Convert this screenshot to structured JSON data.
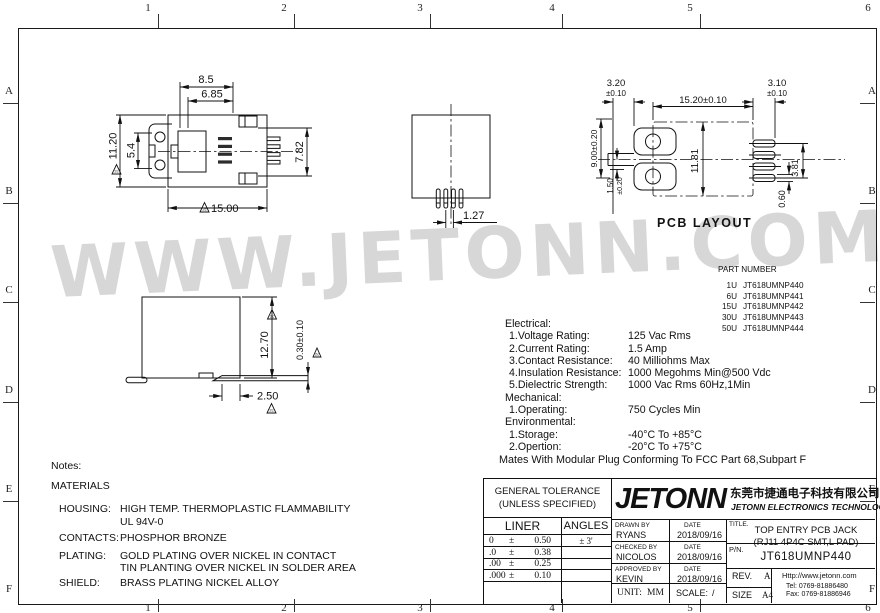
{
  "frame": {
    "cols": [
      "1",
      "2",
      "3",
      "4",
      "5",
      "6"
    ],
    "rows": [
      "A",
      "B",
      "C",
      "D",
      "E",
      "F"
    ]
  },
  "watermark": "WWW.JETONN.COM",
  "dims": {
    "rev_marker": "2c",
    "top_view": {
      "w_outer": "8.5",
      "w_inner": "6.85",
      "h_outer": "11.20",
      "h_inner": "5.4",
      "h_right": "7.82",
      "w_body": "15.00"
    },
    "front_view": {
      "pitch": "1.27"
    },
    "pcb": {
      "label": "PCB LAYOUT",
      "pad_left_w": "3.20",
      "pad_left_tol": "±0.10",
      "body_w": "15.20±0.10",
      "pad_right_w": "3.10",
      "pad_right_tol": "±0.10",
      "v_span": "9.00±0.20",
      "slot_h": "1.50",
      "slot_tol": "±0.20",
      "body_h": "11.81",
      "pad_span": "3.81",
      "pad_h": "0.60"
    },
    "side_view": {
      "h": "12.70",
      "pad_t": "0.30±0.10",
      "w": "2.50"
    }
  },
  "part_table": {
    "title": "PART NUMBER",
    "rows": [
      {
        "qty": "1U",
        "pn": "JT618UMNP440"
      },
      {
        "qty": "6U",
        "pn": "JT618UMNP441"
      },
      {
        "qty": "15U",
        "pn": "JT618UMNP442"
      },
      {
        "qty": "30U",
        "pn": "JT618UMNP443"
      },
      {
        "qty": "50U",
        "pn": "JT618UMNP444"
      }
    ]
  },
  "specs": {
    "electrical_title": "Electrical:",
    "electrical": [
      {
        "label": "1.Voltage Rating:",
        "value": "125 Vac Rms"
      },
      {
        "label": "2.Current Rating:",
        "value": "1.5 Amp"
      },
      {
        "label": "3.Contact Resistance:",
        "value": "40 Milliohms Max"
      },
      {
        "label": "4.Insulation Resistance:",
        "value": "1000 Megohms Min@500 Vdc"
      },
      {
        "label": "5.Dielectric Strength:",
        "value": "1000 Vac Rms 60Hz,1Min"
      }
    ],
    "mechanical_title": "Mechanical:",
    "mechanical": [
      {
        "label": "1.Operating:",
        "value": "750 Cycles Min"
      }
    ],
    "environmental_title": "Environmental:",
    "environmental": [
      {
        "label": "1.Storage:",
        "value": "-40°C To +85°C"
      },
      {
        "label": "2.Opertion:",
        "value": "-20°C To +75°C"
      }
    ],
    "footnote": "Mates With Modular Plug Conforming To FCC Part 68,Subpart F"
  },
  "notes": {
    "title": "Notes:",
    "materials": "MATERIALS",
    "items": [
      {
        "label": "HOUSING:",
        "lines": [
          "HIGH TEMP. THERMOPLASTIC FLAMMABILITY",
          "UL 94V-0"
        ]
      },
      {
        "label": "CONTACTS:",
        "lines": [
          "PHOSPHOR BRONZE"
        ]
      },
      {
        "label": "PLATING:",
        "lines": [
          "GOLD PLATING OVER NICKEL IN CONTACT",
          "TIN PLANTING OVER NICKEL IN SOLDER AREA"
        ]
      },
      {
        "label": "SHIELD:",
        "lines": [
          "BRASS PLATING NICKEL ALLOY"
        ]
      }
    ]
  },
  "title_block": {
    "tolerance": {
      "header1": "GENERAL TOLERANCE",
      "header2": "(UNLESS SPECIFIED)",
      "col1": "LINER",
      "col2": "ANGLES",
      "pm": "±",
      "rows": [
        {
          "p": "0",
          "v": "0.50"
        },
        {
          "p": ".0",
          "v": "0.38"
        },
        {
          "p": ".00",
          "v": "0.25"
        },
        {
          "p": ".000",
          "v": "0.10"
        }
      ],
      "angle": "± 3'"
    },
    "logo": "JETONN",
    "company_cn": "东莞市捷通电子科技有限公司",
    "company_en": "JETONN ELECTRONICS TECHNOLOGY",
    "drawn_label": "DRAWN BY",
    "drawn_name": "RYANS",
    "date_label": "DATE",
    "drawn_date": "2018/09/16",
    "checked_label": "CHECKED BY",
    "checked_name": "NICOLOS",
    "checked_date": "2018/09/16",
    "approved_label": "APPROVED BY",
    "approved_name": "KEVIN",
    "approved_date": "2018/09/16",
    "unit_label": "UNIT:",
    "unit_value": "MM",
    "scale_label": "SCALE:",
    "scale_value": "/",
    "title_label": "TITLE.",
    "title_line1": "TOP ENTRY PCB JACK",
    "title_line2": "(RJ11 4P4C SMT,L PAD)",
    "pn_label": "P/N.",
    "pn_value": "JT618UMNP440",
    "rev_label": "REV.",
    "rev_value": "A",
    "size_label": "SIZE",
    "size_value": "A4",
    "website": "Http://www.jetonn.com",
    "tel": "Tel: 0769-81886480",
    "fax": "Fax: 0769-81886946"
  }
}
